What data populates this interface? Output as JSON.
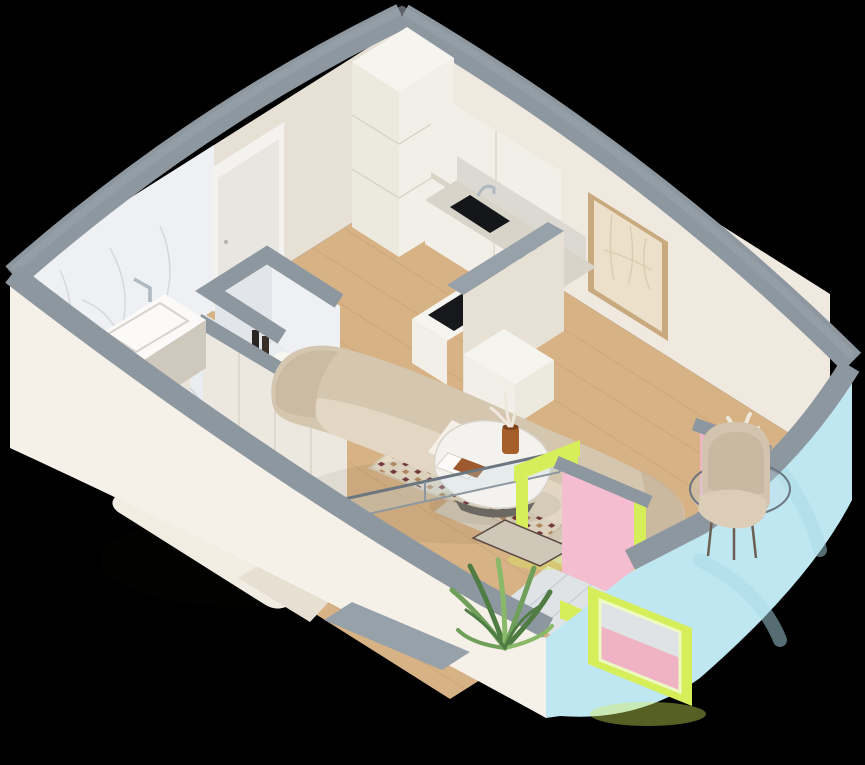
{
  "scene": {
    "type": "isometric-3d-apartment-cutaway-render",
    "background": "#000000",
    "rooms": [
      {
        "name": "bathroom",
        "floor": "white marble",
        "features": [
          "marble-wall",
          "vanity-sink",
          "chrome-faucet",
          "open-door-panel",
          "laundry-niche",
          "washing-machine",
          "detergent-bottles"
        ]
      },
      {
        "name": "kitchen",
        "floor": "light wood",
        "features": [
          "tall-cabinet-column",
          "upper-cabinets",
          "marble-backsplash",
          "marble-counter",
          "black-sink",
          "round-tray",
          "induction-cooktop",
          "peninsula-half-wall",
          "low-bench"
        ]
      },
      {
        "name": "living-area",
        "floor": "light wood",
        "features": [
          "curved-sofa",
          "sofa-pillow",
          "wall-art",
          "patterned-rug",
          "plain-rug",
          "coffee-table",
          "open-book",
          "amber-vase",
          "armchair",
          "glass-side-table",
          "dried-flowers"
        ]
      },
      {
        "name": "sleeping-area",
        "floor": "light wood",
        "features": [
          "double-bed",
          "pillows",
          "throw-blanket",
          "wardrobe",
          "square-pillar",
          "entrance-door"
        ]
      },
      {
        "name": "balcony",
        "floor": "gray tile",
        "features": [
          "pink-walls",
          "lime-door-frame",
          "lime-window-frame",
          "palm-plant",
          "door-mat",
          "glass-partition"
        ]
      }
    ],
    "exterior": {
      "left_wall": "white plaster",
      "right_facade": "light blue plaster",
      "wall_tops": "gray concrete caps"
    }
  },
  "colors": {
    "background": "#000000",
    "wallCap": "#8d97a0",
    "wallCapLight": "#9aa4ac",
    "wallCream": "#efe9e0",
    "wallCreamShade": "#e7e0d5",
    "whiteExterior": "#f5f0e8",
    "facadeBlue": "#bfe7f1",
    "facadeBlueShade": "#a9d9e6",
    "marbleWall": "#eef0f3",
    "marbleWallShade": "#e2e6ea",
    "marbleFloor": "#e9edf0",
    "marbleVein": "#b9c2cb",
    "woodFloor": "#d7b285",
    "woodPlank": "#a87c4f",
    "kitchenCabinet": "#f2efe8",
    "kitchenCabinetBright": "#f6f4ef",
    "kitchenCabinetSide": "#eceade",
    "counterTop": "#d8d4ca",
    "backsplash": "#dcd9d2",
    "cooktopBlack": "#17181b",
    "sinkBlack": "#141619",
    "chrome": "#aeb9c2",
    "sofaBeige": "#d5c6b0",
    "sofaBeigeShade": "#c4b299",
    "seatBeige": "#e3d7c3",
    "pillowWhite": "#f5f1e8",
    "armchairBeige": "#d2c4ae",
    "armchairCushion": "#dbcdb7",
    "artFrame": "#c9a97e",
    "artPaper": "#ece0cb",
    "artStroke": "#cdbb9b",
    "rugCream": "#e7dcc8",
    "rugMaroon": "#7b3c40",
    "rugTan": "#b98c63",
    "rugPlain": "#dcd3bf",
    "tableWhite": "#f4f2ee",
    "tableBase": "#6b6862",
    "vaseAmber": "#a55f2a",
    "driedWhite": "#efe9dd",
    "bedWhite": "#f2ede3",
    "bedShade": "#d9d1c3",
    "bedWood": "#c59a6b",
    "throwBeige": "#e7e0d2",
    "wardrobeWhite": "#ece8e0",
    "doorWhite": "#e8e6e1",
    "doorFrame": "#f4f2ee",
    "vanityBeige": "#d9d3c7",
    "basinWhite": "#fbfaf8",
    "applianceWhite": "#fafafa",
    "balconyPink": "#f5bed0",
    "balconyPinkShade": "#f0b3c6",
    "lime": "#d6ee5a",
    "limeLight": "#eefbc0",
    "glassTint": "rgba(195,220,232,0.28)",
    "glassFrame": "#6b7680",
    "plantGreen": "#6f9f5a",
    "plantGreenDark": "#4e7c42",
    "plantGreenLight": "#8ab869",
    "tileGray": "#dfe3e6",
    "stepGray": "#97a1a9",
    "shadow": "rgba(35,25,15,0.28)"
  }
}
